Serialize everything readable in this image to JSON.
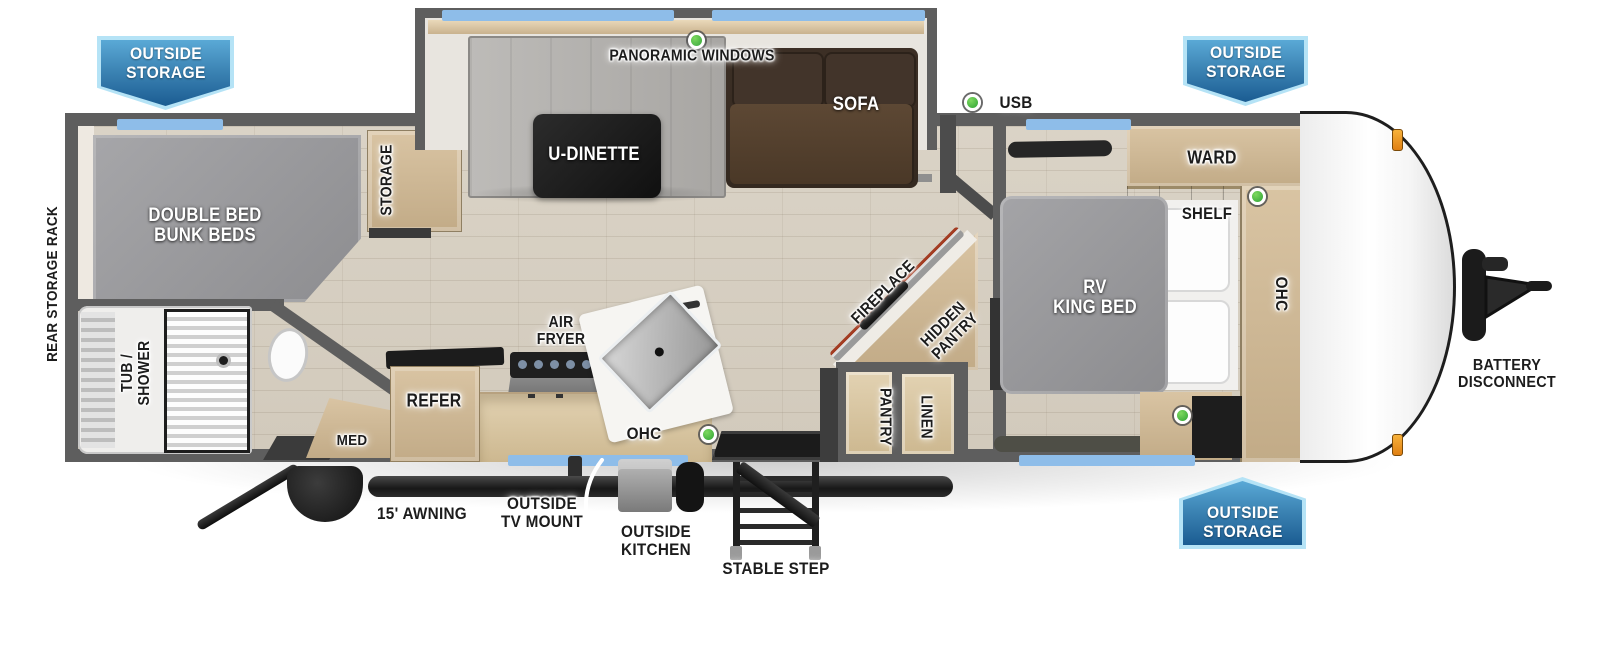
{
  "title": "Travel trailer floor plan",
  "badges": {
    "outside_storage": "OUTSIDE\nSTORAGE"
  },
  "labels": {
    "panoramic_windows": "PANORAMIC WINDOWS",
    "usb": "USB",
    "u_dinette": "U-DINETTE",
    "sofa": "SOFA",
    "double_bed_bunk_beds": "DOUBLE BED\nBUNK BEDS",
    "storage": "STORAGE",
    "rear_storage_rack": "REAR STORAGE RACK",
    "tub_shower": "TUB /\nSHOWER",
    "med": "MED",
    "refer": "REFER",
    "air_fryer": "AIR\nFRYER",
    "ohc_kitchen": "OHC",
    "fireplace": "FIREPLACE",
    "hidden_pantry": "HIDDEN\nPANTRY",
    "pantry": "PANTRY",
    "linen": "LINEN",
    "rv_king_bed": "RV\nKING BED",
    "ward": "WARD",
    "shelf": "SHELF",
    "ohc_bedroom": "OHC",
    "battery_disconnect": "BATTERY\nDISCONNECT",
    "awning": "15' AWNING",
    "outside_tv_mount": "OUTSIDE\nTV MOUNT",
    "outside_kitchen": "OUTSIDE\nKITCHEN",
    "stable_step": "STABLE STEP"
  },
  "colors": {
    "badge_blue_top": "#5aa9d6",
    "badge_blue_bottom": "#1b5c92",
    "badge_border": "#b5e3f6",
    "window_blue": "#8ebde9",
    "indicator_green": "#2ea335",
    "marker_orange": "#f0961e",
    "wall_gray": "#5e5e5e",
    "floor_wood": "#d6cec0",
    "sofa_brown": "#50402e",
    "mattress_gray": "#9a9a9d"
  }
}
